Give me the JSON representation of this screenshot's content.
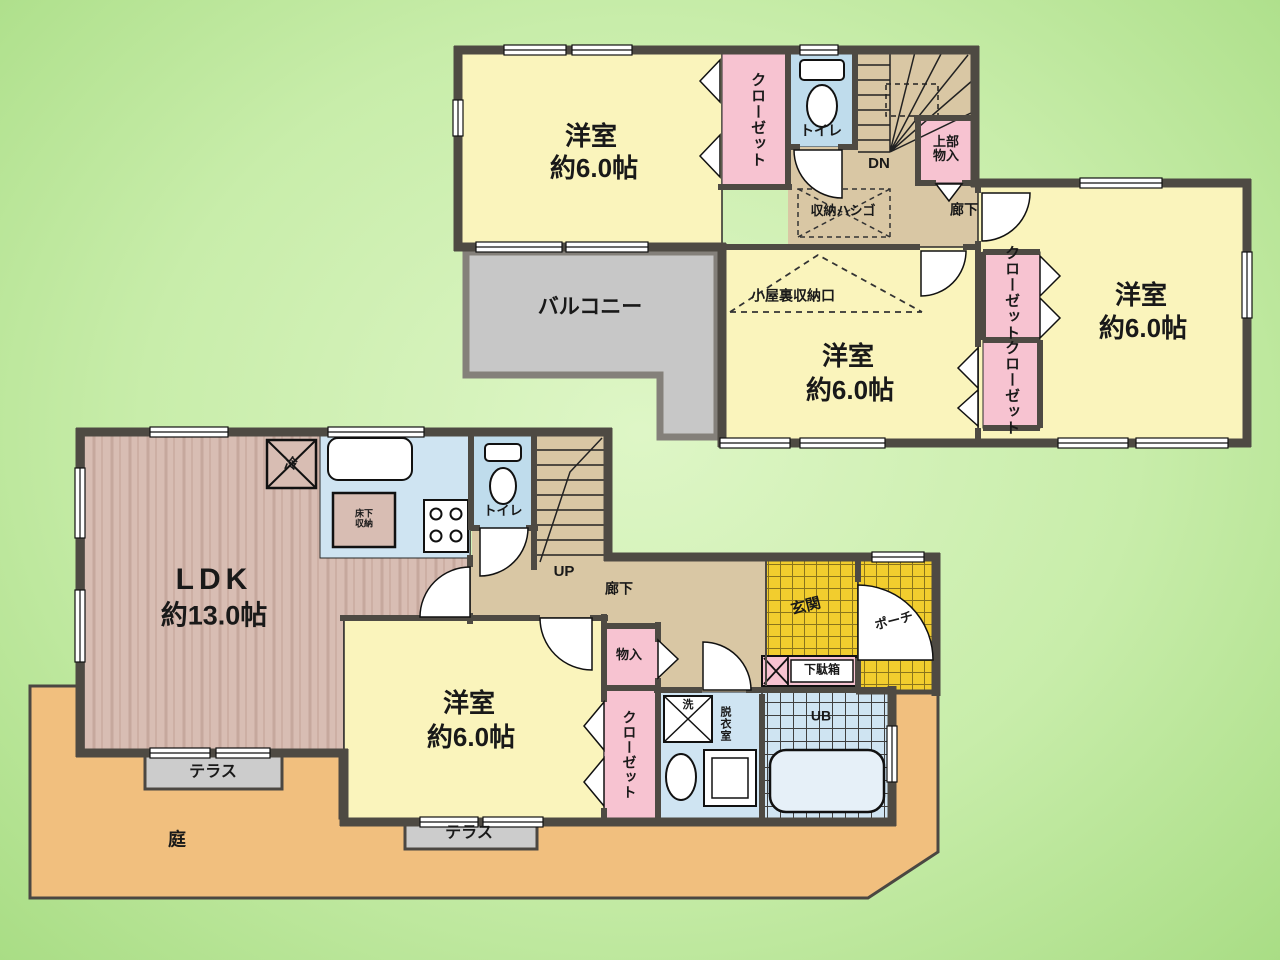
{
  "plan_type": "間取り図",
  "colors": {
    "background_green": "#c8edaa",
    "wall": "#4e4a43",
    "room_yellow": "#faf4bc",
    "closet_pink": "#f7c3d1",
    "water_blue": "#bfdcec",
    "corridor_tan": "#d9c7a4",
    "wood_floor": "#d8bdb3",
    "balcony_gray": "#c7c7c7",
    "garden_orange": "#f1bf7e",
    "tile_yellow": "#f2cd2e"
  },
  "floor2": {
    "room_nw": {
      "name": "洋室",
      "size": "約6.0帖"
    },
    "room_center": {
      "name": "洋室",
      "size": "約6.0帖"
    },
    "room_e": {
      "name": "洋室",
      "size": "約6.0帖"
    },
    "closet_nw": "クローゼット",
    "closet_e1": "クローゼット",
    "closet_e2": "クローゼット",
    "toilet": "トイレ",
    "stairs_down": "DN",
    "upper_storage": "上部物入",
    "ladder": "収納ハシゴ",
    "hallway": "廊下",
    "attic_access": "小屋裏収納口",
    "balcony": "バルコニー"
  },
  "floor1": {
    "ldk": {
      "name": "LDK",
      "size": "約13.0帖"
    },
    "bedroom": {
      "name": "洋室",
      "size": "約6.0帖"
    },
    "fridge": "冷",
    "floor_storage": "床下収納",
    "toilet": "トイレ",
    "stairs_up": "UP",
    "hallway": "廊下",
    "storage": "物入",
    "closet": "クローゼット",
    "entrance": "玄関",
    "porch": "ポーチ",
    "shoe_box": "下駄箱",
    "washer": "洗",
    "dressing_room": "脱衣室",
    "unit_bath": "UB",
    "terrace_left": "テラス",
    "terrace_right": "テラス",
    "garden": "庭"
  }
}
